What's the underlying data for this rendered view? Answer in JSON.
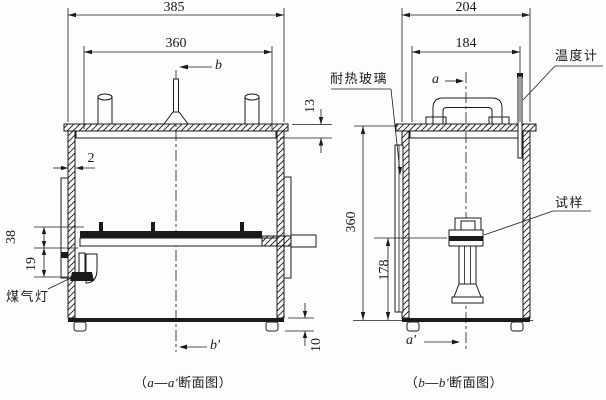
{
  "colors": {
    "line": "#1a1a1a",
    "background": "#fdfdfb"
  },
  "left_view": {
    "dims": {
      "overall_width": "385",
      "inner_width": "360",
      "lid_stack": "13",
      "wall_thickness": "2",
      "shelf_drop": "38",
      "burner_drop": "19",
      "foot_height": "10"
    },
    "sections": {
      "top": "b",
      "bottom": "b'"
    },
    "labels": {
      "gas_burner": "煤气灯"
    },
    "caption": {
      "open": "（",
      "s1": "a",
      "dash": "—",
      "s2": "a'",
      "rest": "断面图）"
    }
  },
  "right_view": {
    "dims": {
      "overall_width": "204",
      "inner_width": "184",
      "inner_height": "360",
      "specimen_center_height": "178"
    },
    "sections": {
      "top": "a",
      "bottom": "a'"
    },
    "labels": {
      "thermometer": "温度计",
      "heat_resistant_glass": "耐热玻璃",
      "specimen": "试样"
    },
    "caption": {
      "open": "（",
      "s1": "b",
      "dash": "—",
      "s2": "b'",
      "rest": "断面图）"
    }
  }
}
